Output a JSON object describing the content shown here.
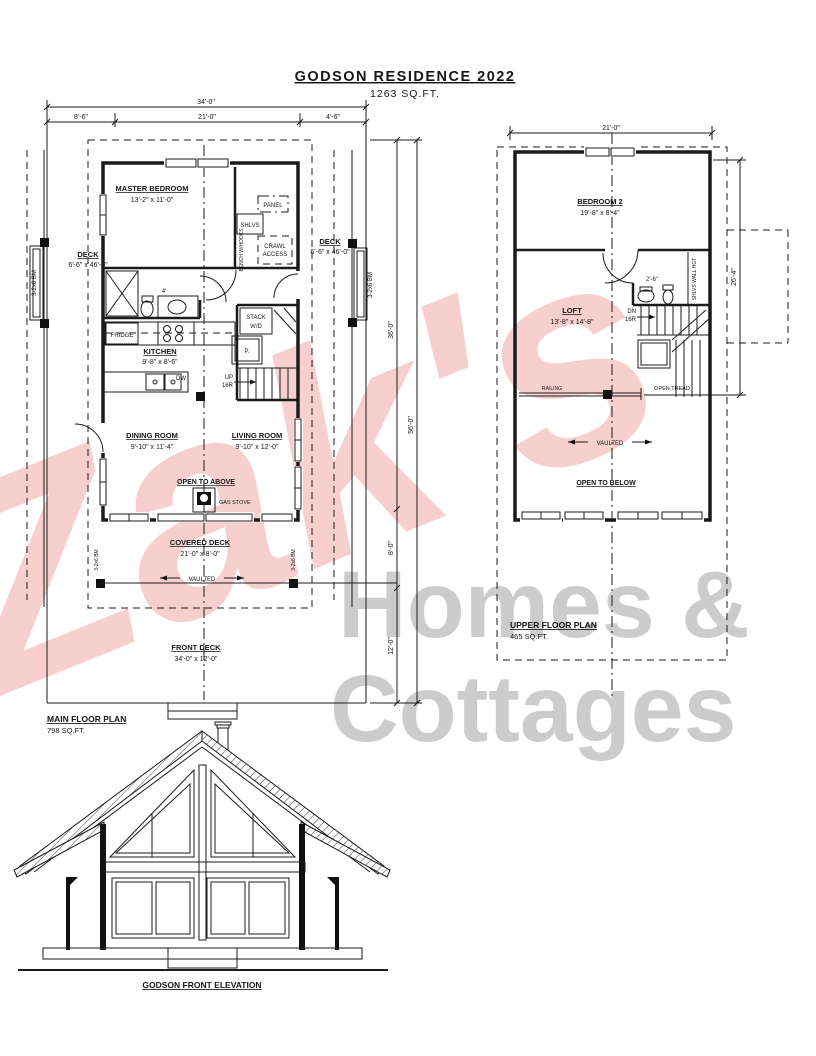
{
  "title": {
    "name": "GODSON RESIDENCE 2022",
    "sqft": "1263 SQ.FT."
  },
  "watermark": {
    "script": "Zak's",
    "line1": "Homes &",
    "line2": "Cottages",
    "script_color": "rgba(235,115,115,0.34)",
    "gray_color": "#cccccc"
  },
  "main": {
    "plan_label": "MAIN FLOOR PLAN",
    "plan_area": "798 SQ.FT.",
    "dim_total_w": "34'-0\"",
    "dim_left": "8'-6\"",
    "dim_mid": "21'-0\"",
    "dim_right": "4'-6\"",
    "dim_house_d": "36'-0\"",
    "dim_cov_deck_d": "8'-0\"",
    "dim_front_deck_d": "12'-0\"",
    "dim_total_d": "56'-0\"",
    "master_name": "MASTER BEDROOM",
    "master_size": "13'-2\" x 11'-0\"",
    "panel": "PANEL",
    "shlvs": "SHLVS",
    "bench": "BENCH W/HOOKS",
    "crawl_1": "CRAWL",
    "crawl_2": "ACCESS",
    "deck_name": "DECK",
    "deck_size": "6'-6\" x 46'-0\"",
    "beam": "3-2x6 BM",
    "bath_dim": "4'",
    "fridge": "FRIDGE",
    "kitchen_name": "KITCHEN",
    "kitchen_size": "9'-8\" x 8'-6\"",
    "dw": "DW",
    "stack_1": "STACK",
    "stack_2": "W/D",
    "pantry": "P.",
    "up_1": "UP",
    "up_2": "16R",
    "dining_name": "DINING ROOM",
    "dining_size": "9'-10\" x 11'-4\"",
    "living_name": "LIVING ROOM",
    "living_size": "9'-10\" x 12'-0\"",
    "open_above": "OPEN TO ABOVE",
    "gas_stove": "GAS STOVE",
    "covered_name": "COVERED DECK",
    "covered_size": "21'-0\" x 8'-0\"",
    "vaulted": "VAULTED",
    "front_name": "FRONT DECK",
    "front_size": "34'-0\" x 12'-0\""
  },
  "upper": {
    "plan_label": "UPPER FLOOR PLAN",
    "plan_area": "465 SQ.FT.",
    "dim_total_w": "21'-0\"",
    "dim_right_d": "26'-4\"",
    "bedroom2_name": "BEDROOM 2",
    "bedroom2_size": "19'-8\" x 8'-4\"",
    "bath_dim": "2'-6\"",
    "shlvs_wall": "SHLVS WALL HGT",
    "dn_1": "DN",
    "dn_2": "16R",
    "loft_name": "LOFT",
    "loft_size": "13'-8\" x 14'-8\"",
    "railing": "RAILING",
    "open_tread": "OPEN TREAD",
    "vaulted": "VAULTED",
    "open_below": "OPEN TO BELOW"
  },
  "elevation": {
    "label": "GODSON FRONT ELEVATION"
  }
}
